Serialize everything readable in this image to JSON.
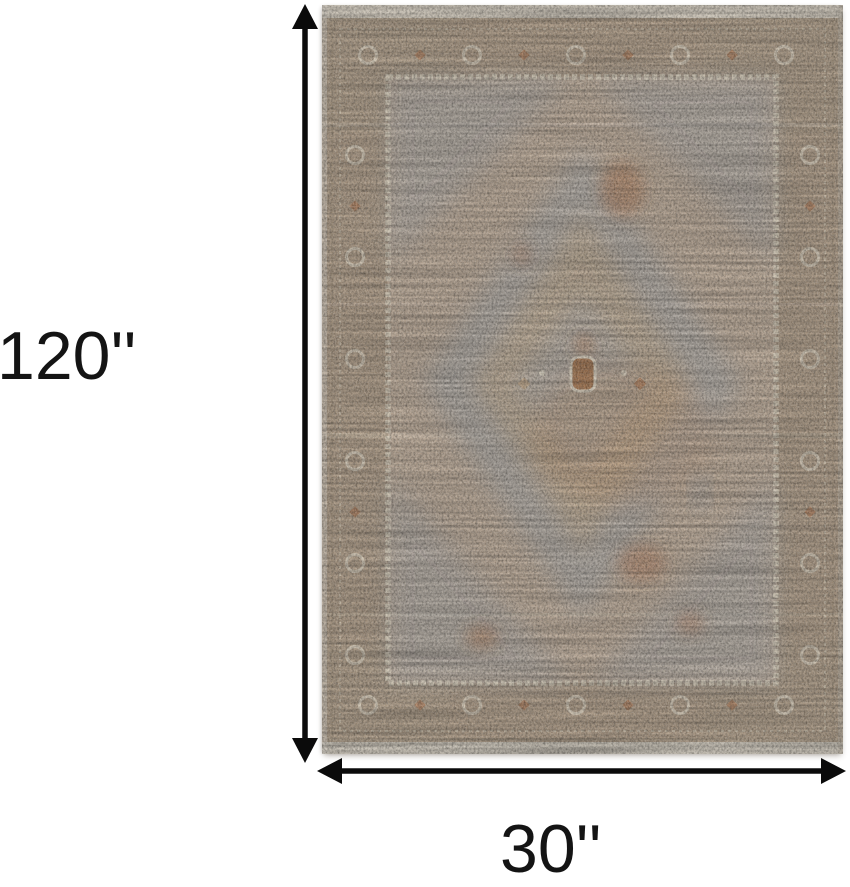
{
  "figure": {
    "height_label": "120''",
    "width_label": "30''",
    "arrow_color": "#0b0b0b",
    "label_color": "#141414"
  },
  "rug": {
    "palette": {
      "base": "#ab9984",
      "field": "#b5a390",
      "border_tint": "#a08b74",
      "selvedge_top": "#cbc3b5",
      "selvedge_bottom": "#c2bbae",
      "medallion_grey": "#9aa0a6",
      "medallion_peach": "#c0a37f",
      "accent_rust": "#a4653c",
      "motif_cream": "#d7cebb"
    }
  }
}
